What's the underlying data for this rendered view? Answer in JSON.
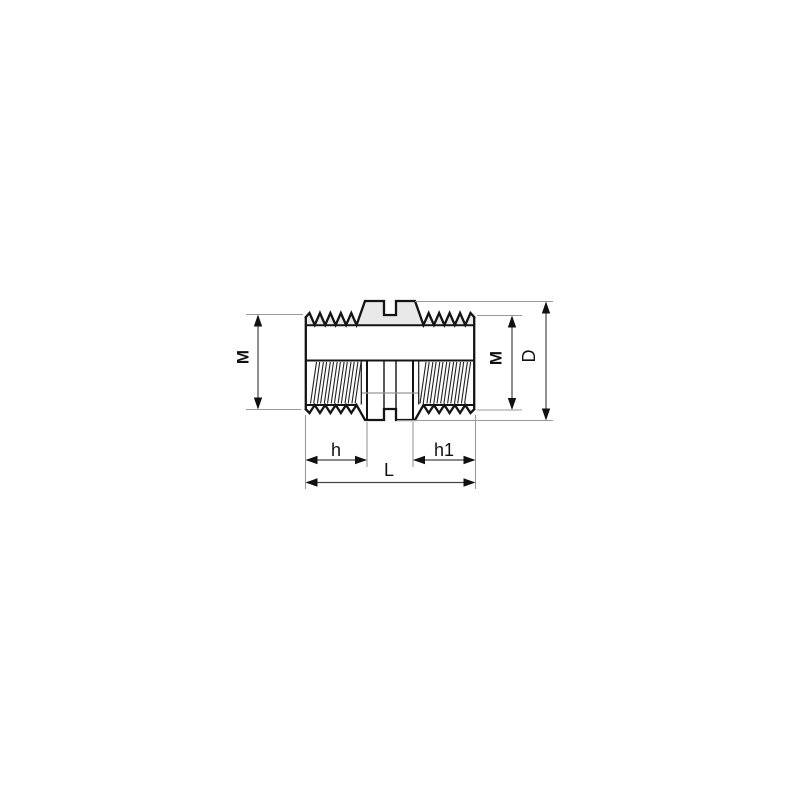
{
  "drawing": {
    "description": "Technical line drawing of a double male threaded nipple pipe fitting, side view with sectioned threads and dimension annotations",
    "labels": {
      "m_left": "M",
      "m_right": "M",
      "outer_diameter": "D",
      "thread_length_left": "h",
      "thread_length_right": "h1",
      "overall_length": "L"
    },
    "colors": {
      "outline": "#141414",
      "dimension_line": "#444444",
      "extension_line": "#9a9a9a",
      "arrowhead": "#111111",
      "top_band_fill": "#e9e9e9",
      "shade_line": "#999999",
      "background": "#ffffff"
    }
  }
}
